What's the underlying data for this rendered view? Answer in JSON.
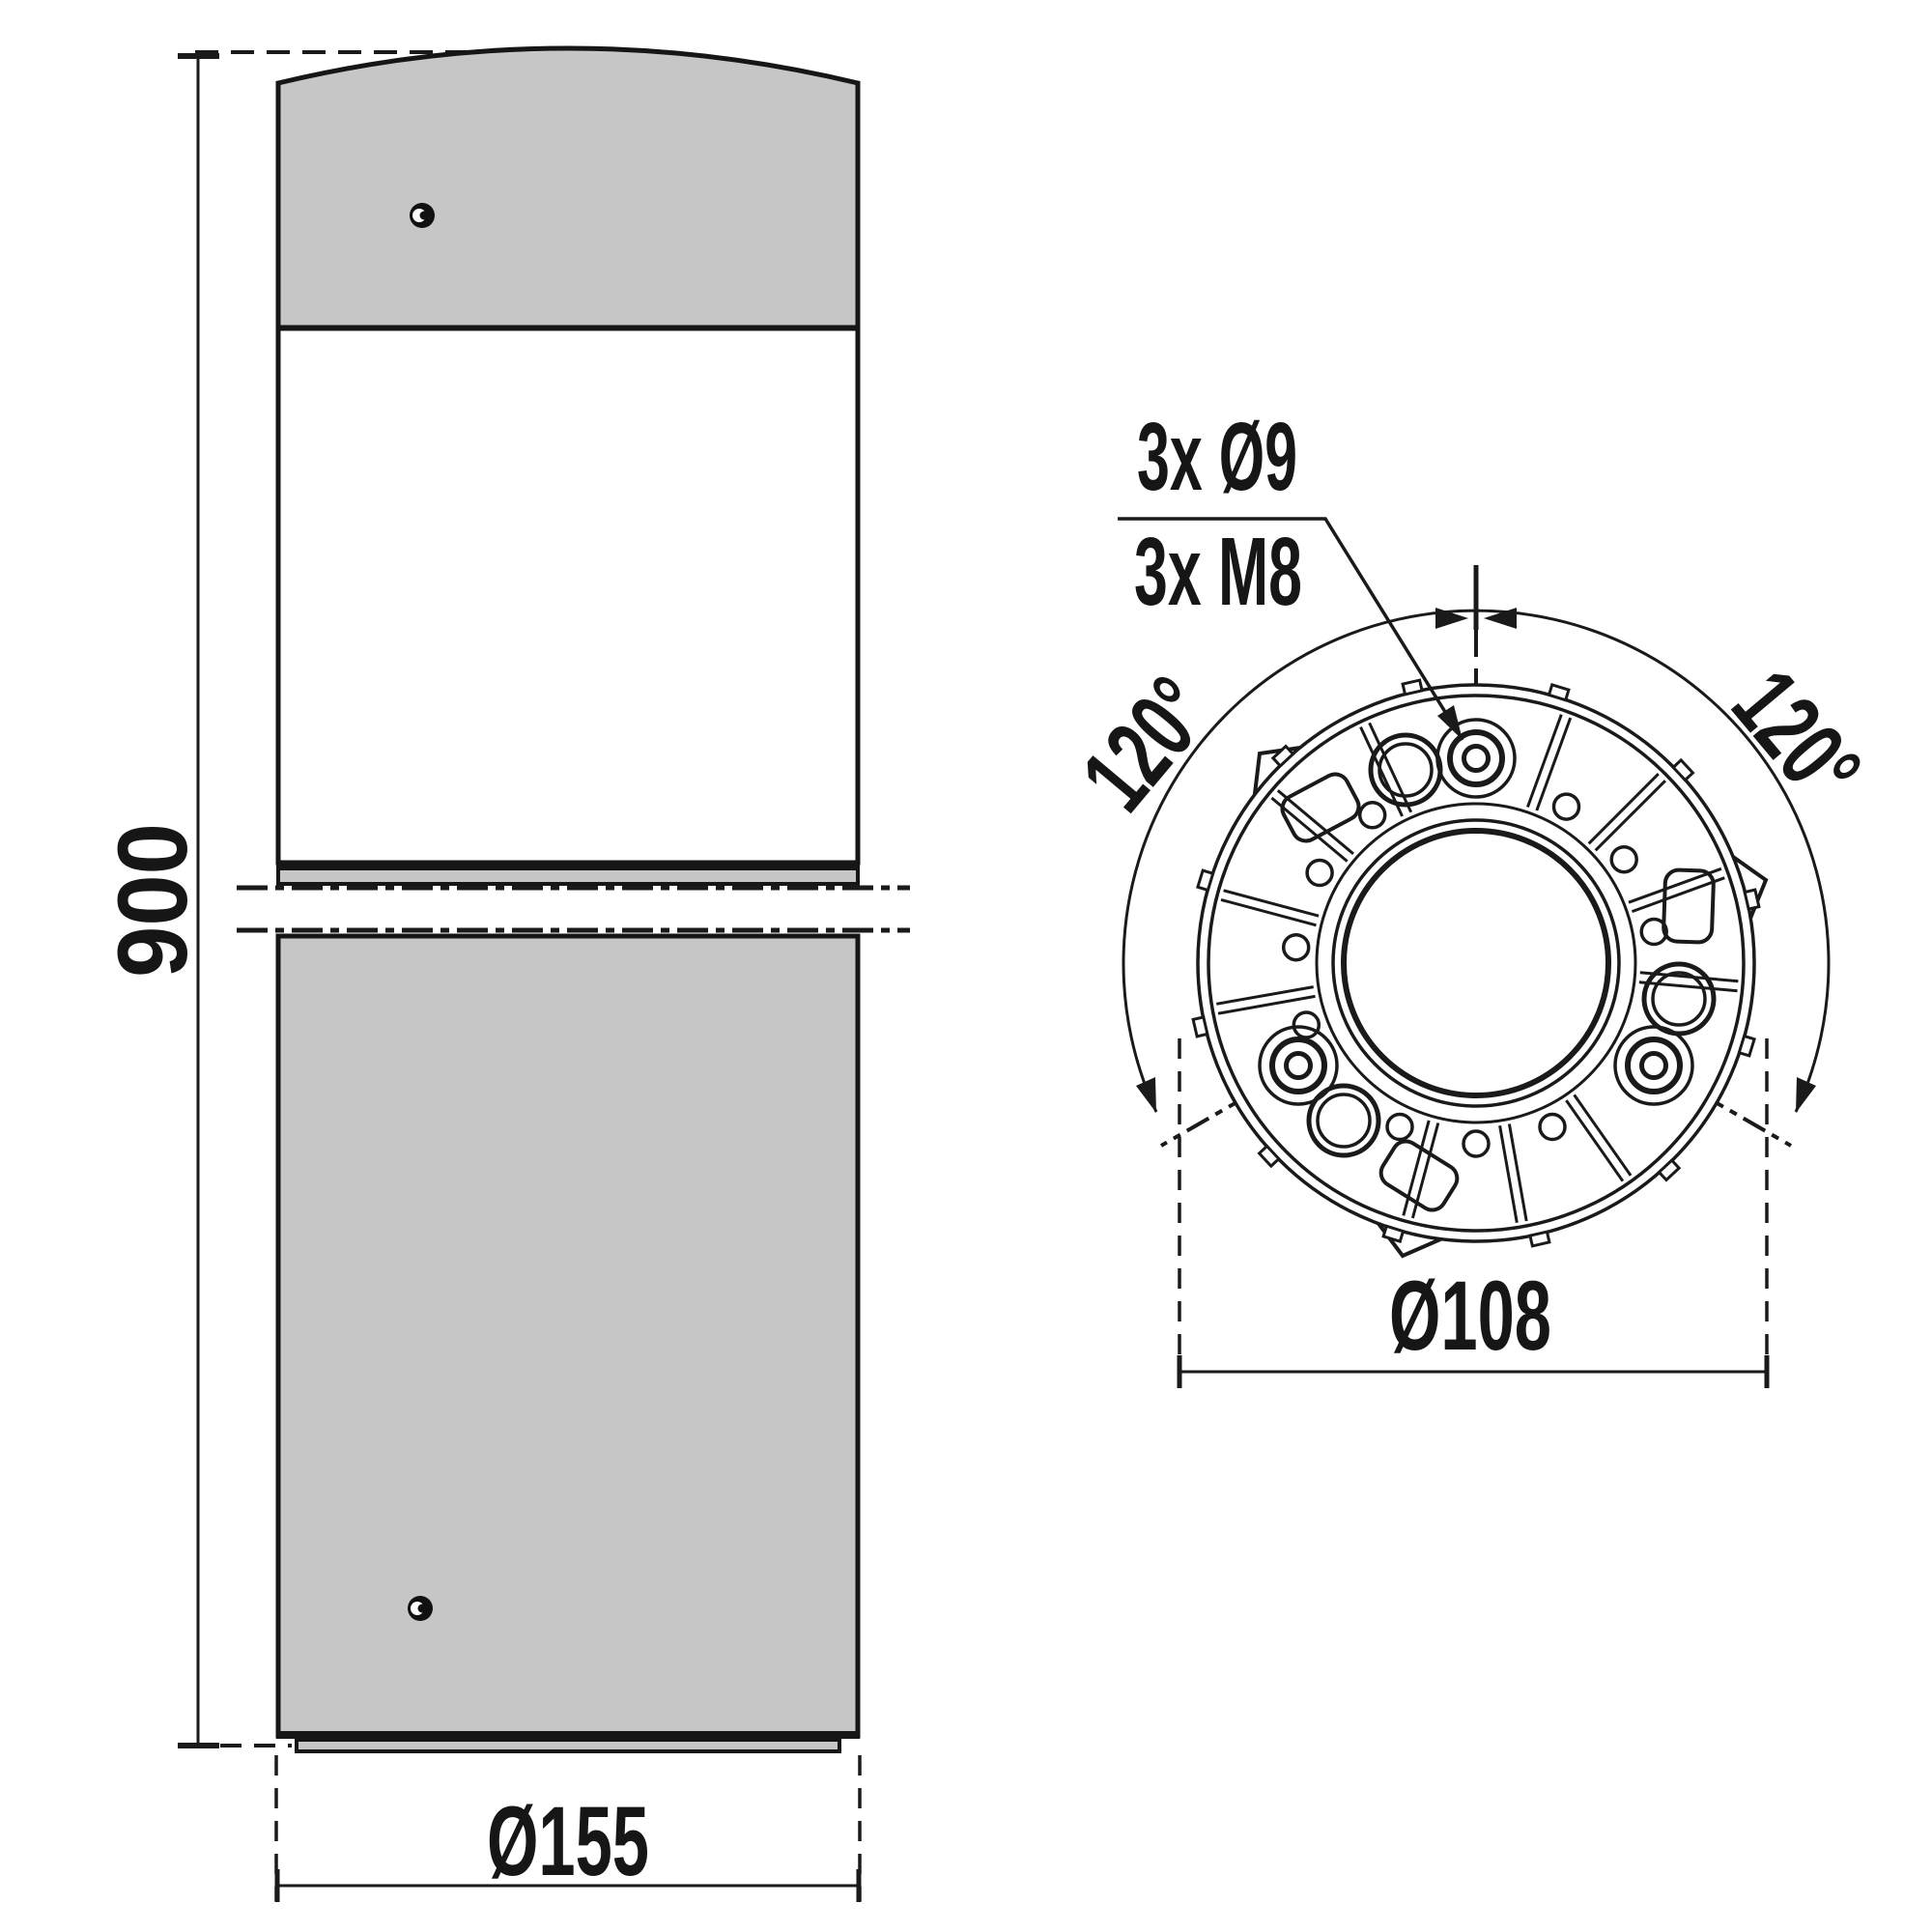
{
  "drawing": {
    "views": {
      "elevation": {
        "height_label": "900",
        "base_diameter_label": "Ø155"
      },
      "plan": {
        "holes_label_top": "3x Ø9",
        "holes_label_bottom": "3x M8",
        "angle_label_left": "120°",
        "angle_label_right": "120°",
        "bolt_circle_label": "Ø108"
      }
    },
    "colors": {
      "line": "#1a1a1a",
      "metal_gray": "#c6c6c6",
      "background": "#ffffff"
    }
  }
}
